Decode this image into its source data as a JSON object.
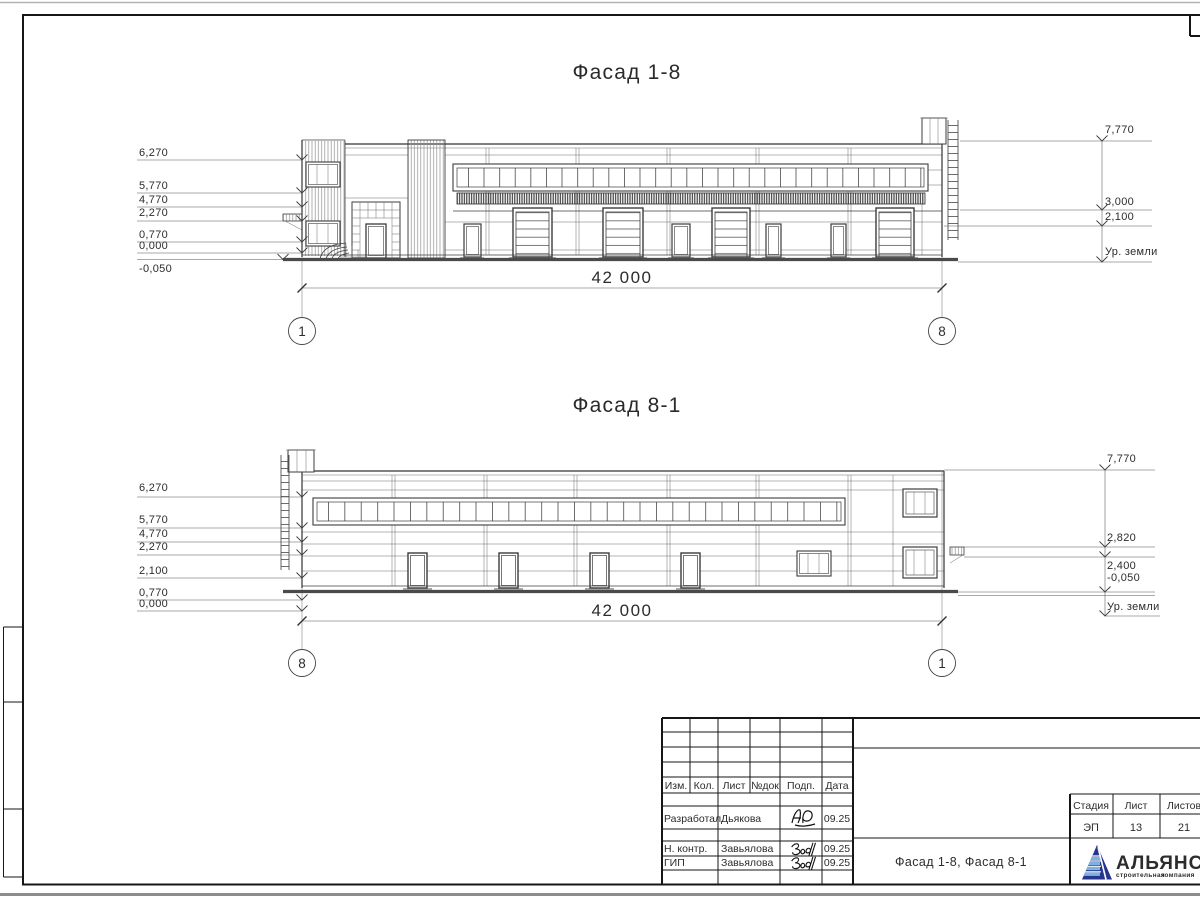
{
  "f1": {
    "title": "Фасад 1-8",
    "dim": "42 000",
    "axisL": "1",
    "axisR": "8",
    "left": [
      "6,270",
      "5,770",
      "4,770",
      "2,270",
      "0,770",
      "0,000",
      "-0,050"
    ],
    "right": [
      "7,770",
      "3,000",
      "2,100",
      "Ур. земли"
    ]
  },
  "f2": {
    "title": "Фасад 8-1",
    "dim": "42 000",
    "axisL": "8",
    "axisR": "1",
    "left": [
      "6,270",
      "5,770",
      "4,770",
      "2,270",
      "2,100",
      "0,770",
      "0,000"
    ],
    "right": [
      "7,770",
      "2,820",
      "2,400",
      "-0,050",
      "Ур. земли"
    ]
  },
  "tb": {
    "cols": [
      "Изм.",
      "Кол.",
      "Лист",
      "№док",
      "Подп.",
      "Дата"
    ],
    "rows": [
      {
        "role": "Разработал",
        "name": "Дьякова",
        "date": "09.25"
      },
      {
        "role": "Н. контр.",
        "name": "Завьялова",
        "date": "09.25"
      },
      {
        "role": "ГИП",
        "name": "Завьялова",
        "date": "09.25"
      }
    ],
    "doc_title": "Фасад 1-8, Фасад 8-1",
    "stage_label": "Стадия",
    "sheet_label": "Лист",
    "sheets_label": "Листов",
    "stage": "ЭП",
    "sheet": "13",
    "sheets": "21",
    "logo_name": "АЛЬЯНС",
    "logo_tagline_1": "строительная",
    "logo_tagline_2": "компания",
    "colors": {
      "logo_blue": "#27358e",
      "bar_blue": "#79b4de",
      "tagline_blue": "#3f9cd6",
      "tagline_red": "#d23a31"
    }
  }
}
